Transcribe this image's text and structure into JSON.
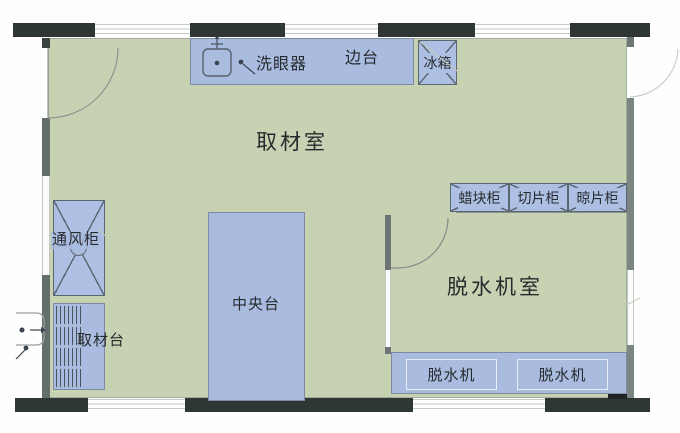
{
  "rooms": {
    "sampling_room": {
      "label": "取材室"
    },
    "dehydration_room": {
      "label": "脱水机室"
    }
  },
  "fixtures": {
    "eye_wash": {
      "label": "洗眼器"
    },
    "side_bench": {
      "label": "边台"
    },
    "fridge": {
      "label": "冰箱"
    },
    "fume_hood": {
      "label": "通风柜"
    },
    "sampling_bench": {
      "label": "取材台"
    },
    "central_bench": {
      "label": "中央台"
    },
    "cabinets": [
      {
        "label": "蜡块柜"
      },
      {
        "label": "切片柜"
      },
      {
        "label": "晾片柜"
      }
    ],
    "dehydrators": [
      {
        "label": "脱水机"
      },
      {
        "label": "脱水机"
      }
    ]
  },
  "icons": {
    "eye_wash_sink": "sink-icon",
    "exterior_sink": "sink-icon"
  },
  "colors": {
    "floor": "#c6d2b2",
    "furniture": "#a9bce0",
    "wall_dark": "#2e3734",
    "wall_gray": "#646f6b",
    "cabinet_fill": "#adc0e4",
    "line": "#5c6670"
  }
}
